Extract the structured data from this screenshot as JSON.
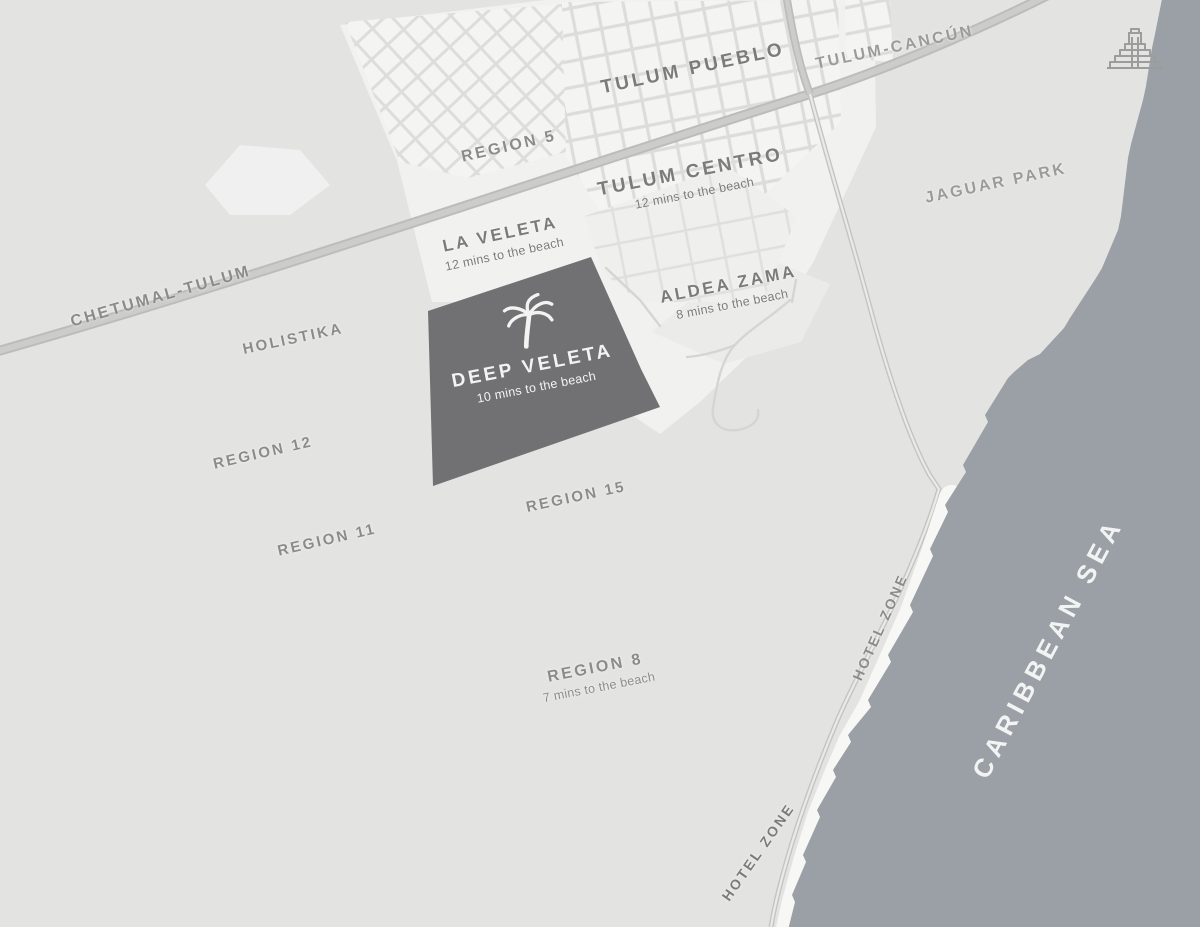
{
  "labels": {
    "tulum_pueblo": {
      "title": "TULUM PUEBLO"
    },
    "tulum_cancun_road": {
      "title": "TULUM-CANCÚN"
    },
    "region_5": {
      "title": "REGION 5"
    },
    "tulum_centro": {
      "title": "TULUM CENTRO",
      "subtitle": "12 mins to the beach"
    },
    "jaguar_park": {
      "title": "JAGUAR PARK"
    },
    "la_veleta": {
      "title": "LA VELETA",
      "subtitle": "12 mins to the beach"
    },
    "aldea_zama": {
      "title": "ALDEA ZAMA",
      "subtitle": "8 mins to the beach"
    },
    "holistika": {
      "title": "HOLISTIKA"
    },
    "chetumal_tulum_road": {
      "title": "CHETUMAL-TULUM"
    },
    "deep_veleta": {
      "title": "DEEP VELETA",
      "subtitle": "10 mins to the beach"
    },
    "region_12": {
      "title": "REGION 12"
    },
    "region_15": {
      "title": "REGION 15"
    },
    "region_11": {
      "title": "REGION 11"
    },
    "region_8": {
      "title": "REGION 8",
      "subtitle": "7 mins to the beach"
    },
    "hotel_zone_north": {
      "title": "HOTEL ZONE"
    },
    "hotel_zone_south": {
      "title": "HOTEL ZONE"
    },
    "caribbean_sea": {
      "title": "CARIBBEAN SEA"
    }
  },
  "icons": {
    "palm_tree": "palm-tree-icon",
    "mayan_pyramid": "mayan-pyramid-icon"
  },
  "colors": {
    "land": "#e3e3e2",
    "sea": "#9aa0a6",
    "beach": "#f7f7f6",
    "highlight_parcel": "#717174",
    "road": "#c6c6c5",
    "label_dark": "#7b7b7b",
    "label_mid": "#8b8b8b",
    "label_on_dark": "#f2f3f3"
  }
}
